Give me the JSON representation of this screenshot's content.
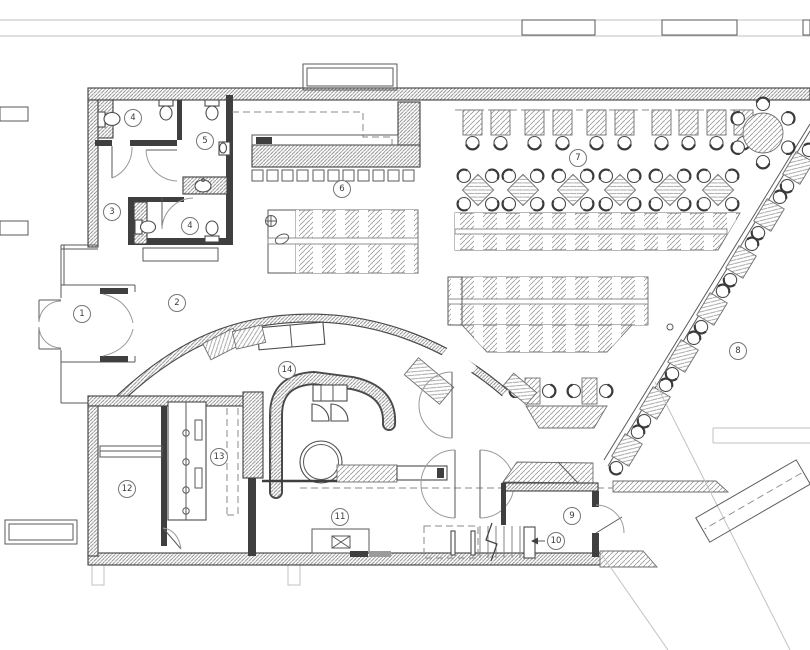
{
  "drawing": {
    "kind": "floor-plan",
    "room_labels": [
      {
        "number": "1",
        "x": 82,
        "y": 314
      },
      {
        "number": "2",
        "x": 177,
        "y": 303
      },
      {
        "number": "3",
        "x": 112,
        "y": 212
      },
      {
        "number": "4",
        "x": 133,
        "y": 118
      },
      {
        "number": "4",
        "x": 190,
        "y": 226
      },
      {
        "number": "5",
        "x": 205,
        "y": 141
      },
      {
        "number": "6",
        "x": 342,
        "y": 189
      },
      {
        "number": "7",
        "x": 578,
        "y": 158
      },
      {
        "number": "8",
        "x": 738,
        "y": 351
      },
      {
        "number": "9",
        "x": 572,
        "y": 516
      },
      {
        "number": "10",
        "x": 556,
        "y": 541
      },
      {
        "number": "11",
        "x": 340,
        "y": 517
      },
      {
        "number": "12",
        "x": 127,
        "y": 489
      },
      {
        "number": "13",
        "x": 219,
        "y": 457
      },
      {
        "number": "14",
        "x": 287,
        "y": 370
      }
    ],
    "colors": {
      "background": "#ffffff",
      "wall_dark": "#3f3f3f",
      "line": "#5a5a5a",
      "hatch": "#9a9a9a",
      "context": "#c2c2c2"
    }
  }
}
